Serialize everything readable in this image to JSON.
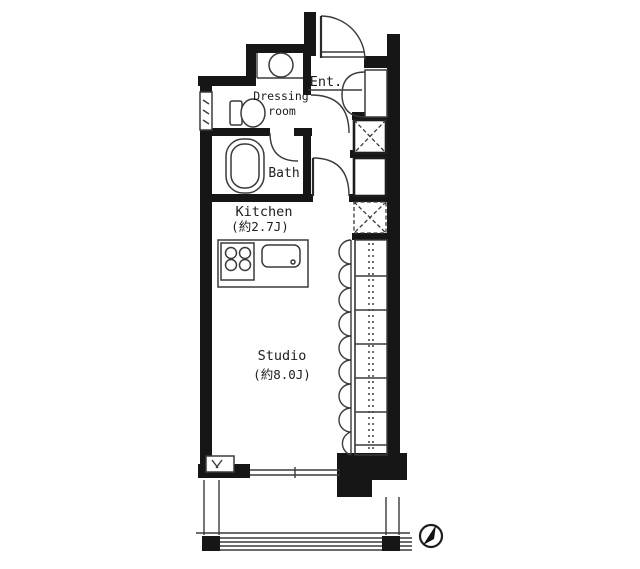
{
  "floor_plan": {
    "labels": {
      "entrance": "Ent.",
      "dressing_line1": "Dressing",
      "dressing_line2": "room",
      "bath": "Bath",
      "kitchen": "Kitchen",
      "kitchen_size": "(約2.7J)",
      "studio": "Studio",
      "studio_size": "(約8.0J)"
    },
    "colors": {
      "wall": "#161616",
      "line": "#3a3a3a",
      "background": "#ffffff"
    }
  }
}
